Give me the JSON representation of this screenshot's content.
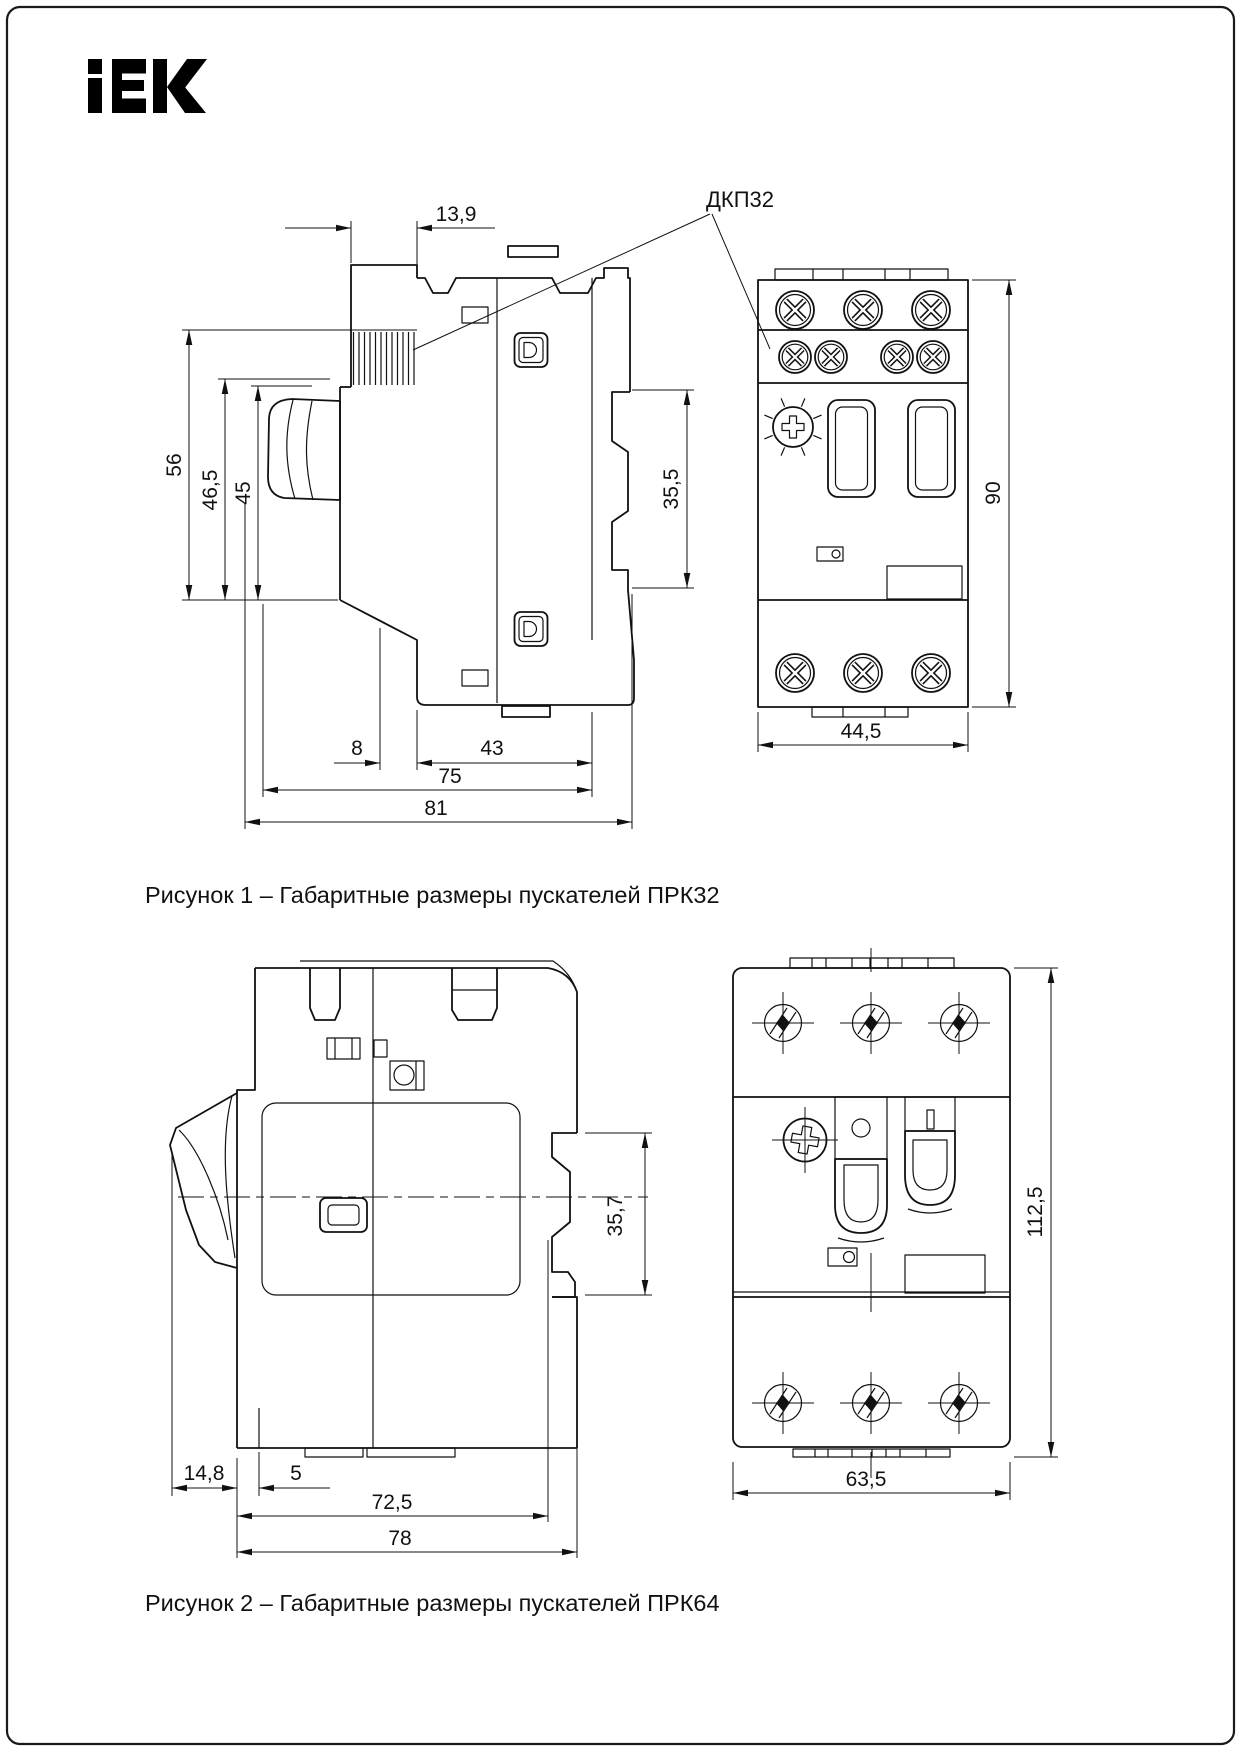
{
  "page": {
    "background": "#ffffff",
    "line_color": "#111111",
    "border_color": "#1a1a1a"
  },
  "logo": {
    "text": "iEK",
    "color": "#000000"
  },
  "figure1": {
    "caption": "Рисунок 1 – Габаритные размеры пускателей ПРК32",
    "callout": "ДКП32",
    "dims": {
      "knob_width": "13,9",
      "height_total": "56",
      "height_front": "46,5",
      "height_inner": "45",
      "rail_height": "35,5",
      "base_offset": "8",
      "body_depth": "43",
      "depth": "75",
      "depth_total": "81",
      "front_width": "44,5",
      "front_height": "90"
    }
  },
  "figure2": {
    "caption": "Рисунок 2 – Габаритные размеры  пускателей ПРК64",
    "dims": {
      "rail_height": "35,7",
      "lever_depth": "14,8",
      "step": "5",
      "body_depth": "72,5",
      "depth_total": "78",
      "front_width": "63,5",
      "front_height": "112,5"
    }
  }
}
